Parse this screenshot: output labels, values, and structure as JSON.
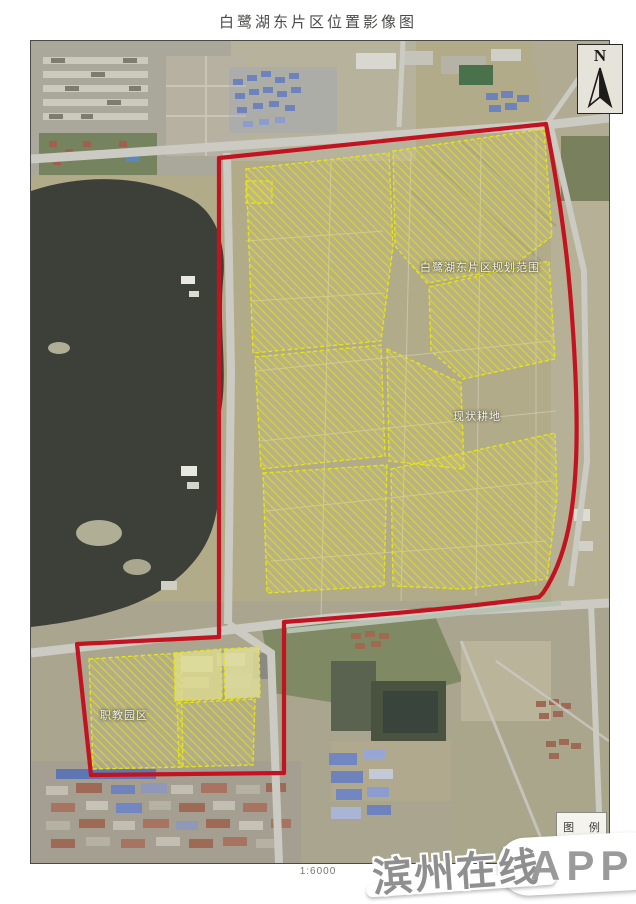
{
  "page": {
    "title": "白鹭湖东片区位置影像图",
    "scale_label": "1:6000"
  },
  "compass": {
    "label": "N"
  },
  "map_labels": [
    {
      "text": "白鹭湖东片区规划范围"
    },
    {
      "text": "现状耕地"
    },
    {
      "text": "职教园区"
    }
  ],
  "legend": {
    "title": "图 例",
    "boundary_symbol_color": "#c41320"
  },
  "watermark": {
    "site_name": "滨州在线",
    "badge": "APP"
  },
  "colors": {
    "boundary_red": "#c41320",
    "parcel_yellow": "#e6e412",
    "lake_water": "#3c4038",
    "road_gray": "#cbcbc3",
    "farmland_base": "#b2ab8a",
    "blue_roof": "#6e82bb",
    "red_roof": "#9e6a55"
  }
}
